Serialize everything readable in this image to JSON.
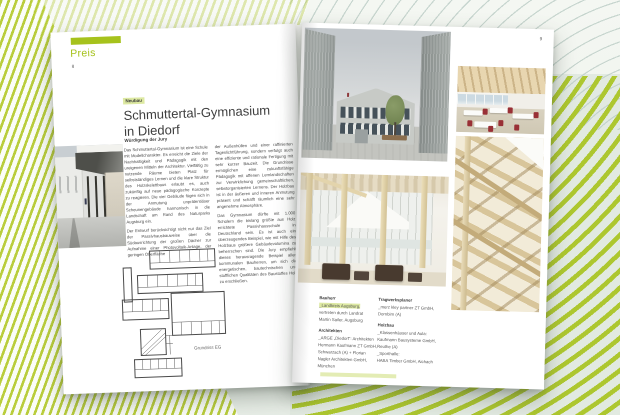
{
  "colors": {
    "accent_green": "#a6c21c",
    "highlight_green": "#dde9a2",
    "stripe_green": "#b9cd3c"
  },
  "page_left": {
    "section_label": "Preis",
    "page_number": "8",
    "category_label": "Neubau",
    "title_line1": "Schmuttertal-Gymnasium",
    "title_line2": "in Diedorf",
    "jury_heading": "Würdigung der Jury",
    "col1_para1": "Das Schmuttertal-Gymnasium ist eine Schule mit Modellcharakter. Es erreicht die Ziele der Nachhaltigkeit und Pädagogik mit den ureigenen Mitteln der Architektur. Vielfältig zu nutzende Räume bieten Platz für selbstständiges Lernen und die klare Struktur des Holzskelettbaus erlaubt es, auch zukünftig auf neue pädagogische Konzepte zu reagieren. Die vier Gebäude fügen sich in der Anmutung unprätentiöser Scheunengebäude harmonisch in die Landschaft am Rand des Naturparks Augsburg ein.",
    "col1_para2": "Der Entwurf berücksichtigt nicht nur das Ziel der Passivhausbauweise über die Südausrichtung der großen Dächer zur Aufnahme einer Photovoltaik-Anlage, der geringen Oberfläche",
    "col2_para1": "der Außenhüllen und einer raffinierten Tageslichtführung, sondern verfolgt auch eine effiziente und rationale Fertigung mit sehr kurzer Bauzeit. Die Grundrisse ermöglichen eine zukunftsfähige Pädagogik mit offenen Lernlandschaften zur Verwirklichung gemeinschaftlichen, selbstorganisierten Lernens. Der Holzbau ist in der äußeren und inneren Anmutung präsent und schafft räumlich eine sehr angenehme Atmosphäre.",
    "col2_para2": "Das Gymnasium dürfte mit 1.000 Schülern die bislang größte aus Holz errichtete Passivhausschule in Deutschland sein. Es ist auch ein überzeugendes Beispiel, wie mit Hilfe des Holzbaus größere Gebäudevolumina zu beherrschen sind. Die Jury empfiehlt dieses herausragende Beispiel allen kommunalen Bauherren, um sich die energetischen, bautechnischen und stofflichen Qualitäten des Baustoffes Holz zu erschließen.",
    "plan_caption": "Grundriss EG"
  },
  "page_right": {
    "page_number": "9",
    "credits": {
      "bauherr_heading": "Bauherr",
      "bauherr_lines": [
        "_Landkreis Augsburg,",
        "vertreten durch Landrat",
        "Martin Sailer, Augsburg"
      ],
      "architekten_heading": "Architekten",
      "architekten_lines": [
        "_ARGE „Diedorf“: Architekten",
        "Hermann Kaufmann ZT GmbH,",
        "Schwarzach (A) + Florian",
        "Nagler Architekten GmbH,",
        "München"
      ],
      "tragwerksplaner_heading": "Tragwerksplaner",
      "tragwerksplaner_lines": [
        "_merz kley partner ZT GmbH,",
        "Dornbirn (A)"
      ],
      "holzbau_heading": "Holzbau",
      "holzbau_lines": [
        "_Klassenhäuser und Aula:",
        "Kaufmann Bausysteme GmbH,",
        "Reuthe (A)",
        "_Sporthalle:",
        "HABA Timber GmbH, Aichach"
      ]
    }
  }
}
